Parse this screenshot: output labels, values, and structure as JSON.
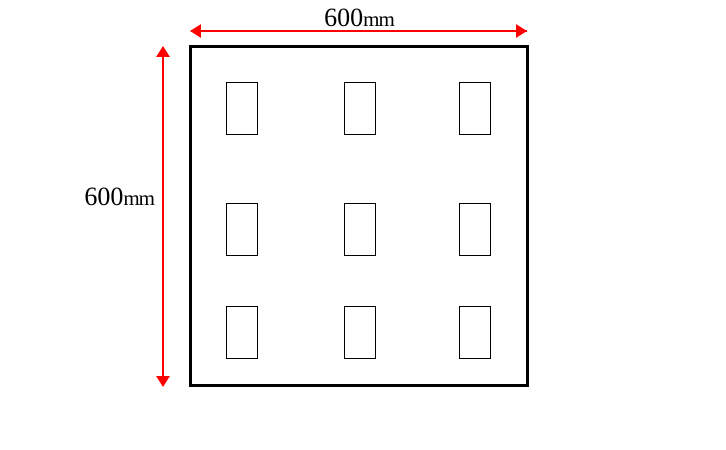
{
  "dimensions": {
    "width": {
      "label": "600mm",
      "value": "600",
      "unit": "mm"
    },
    "height": {
      "label": "600mm",
      "value": "600",
      "unit": "mm"
    }
  },
  "panel": {
    "shape": "square",
    "cutout_rows": 3,
    "cutout_cols": 3,
    "cutout_count": 9
  },
  "colors": {
    "dimension-color": "#ff0000",
    "outline-color": "#000000",
    "background-color": "#ffffff"
  }
}
